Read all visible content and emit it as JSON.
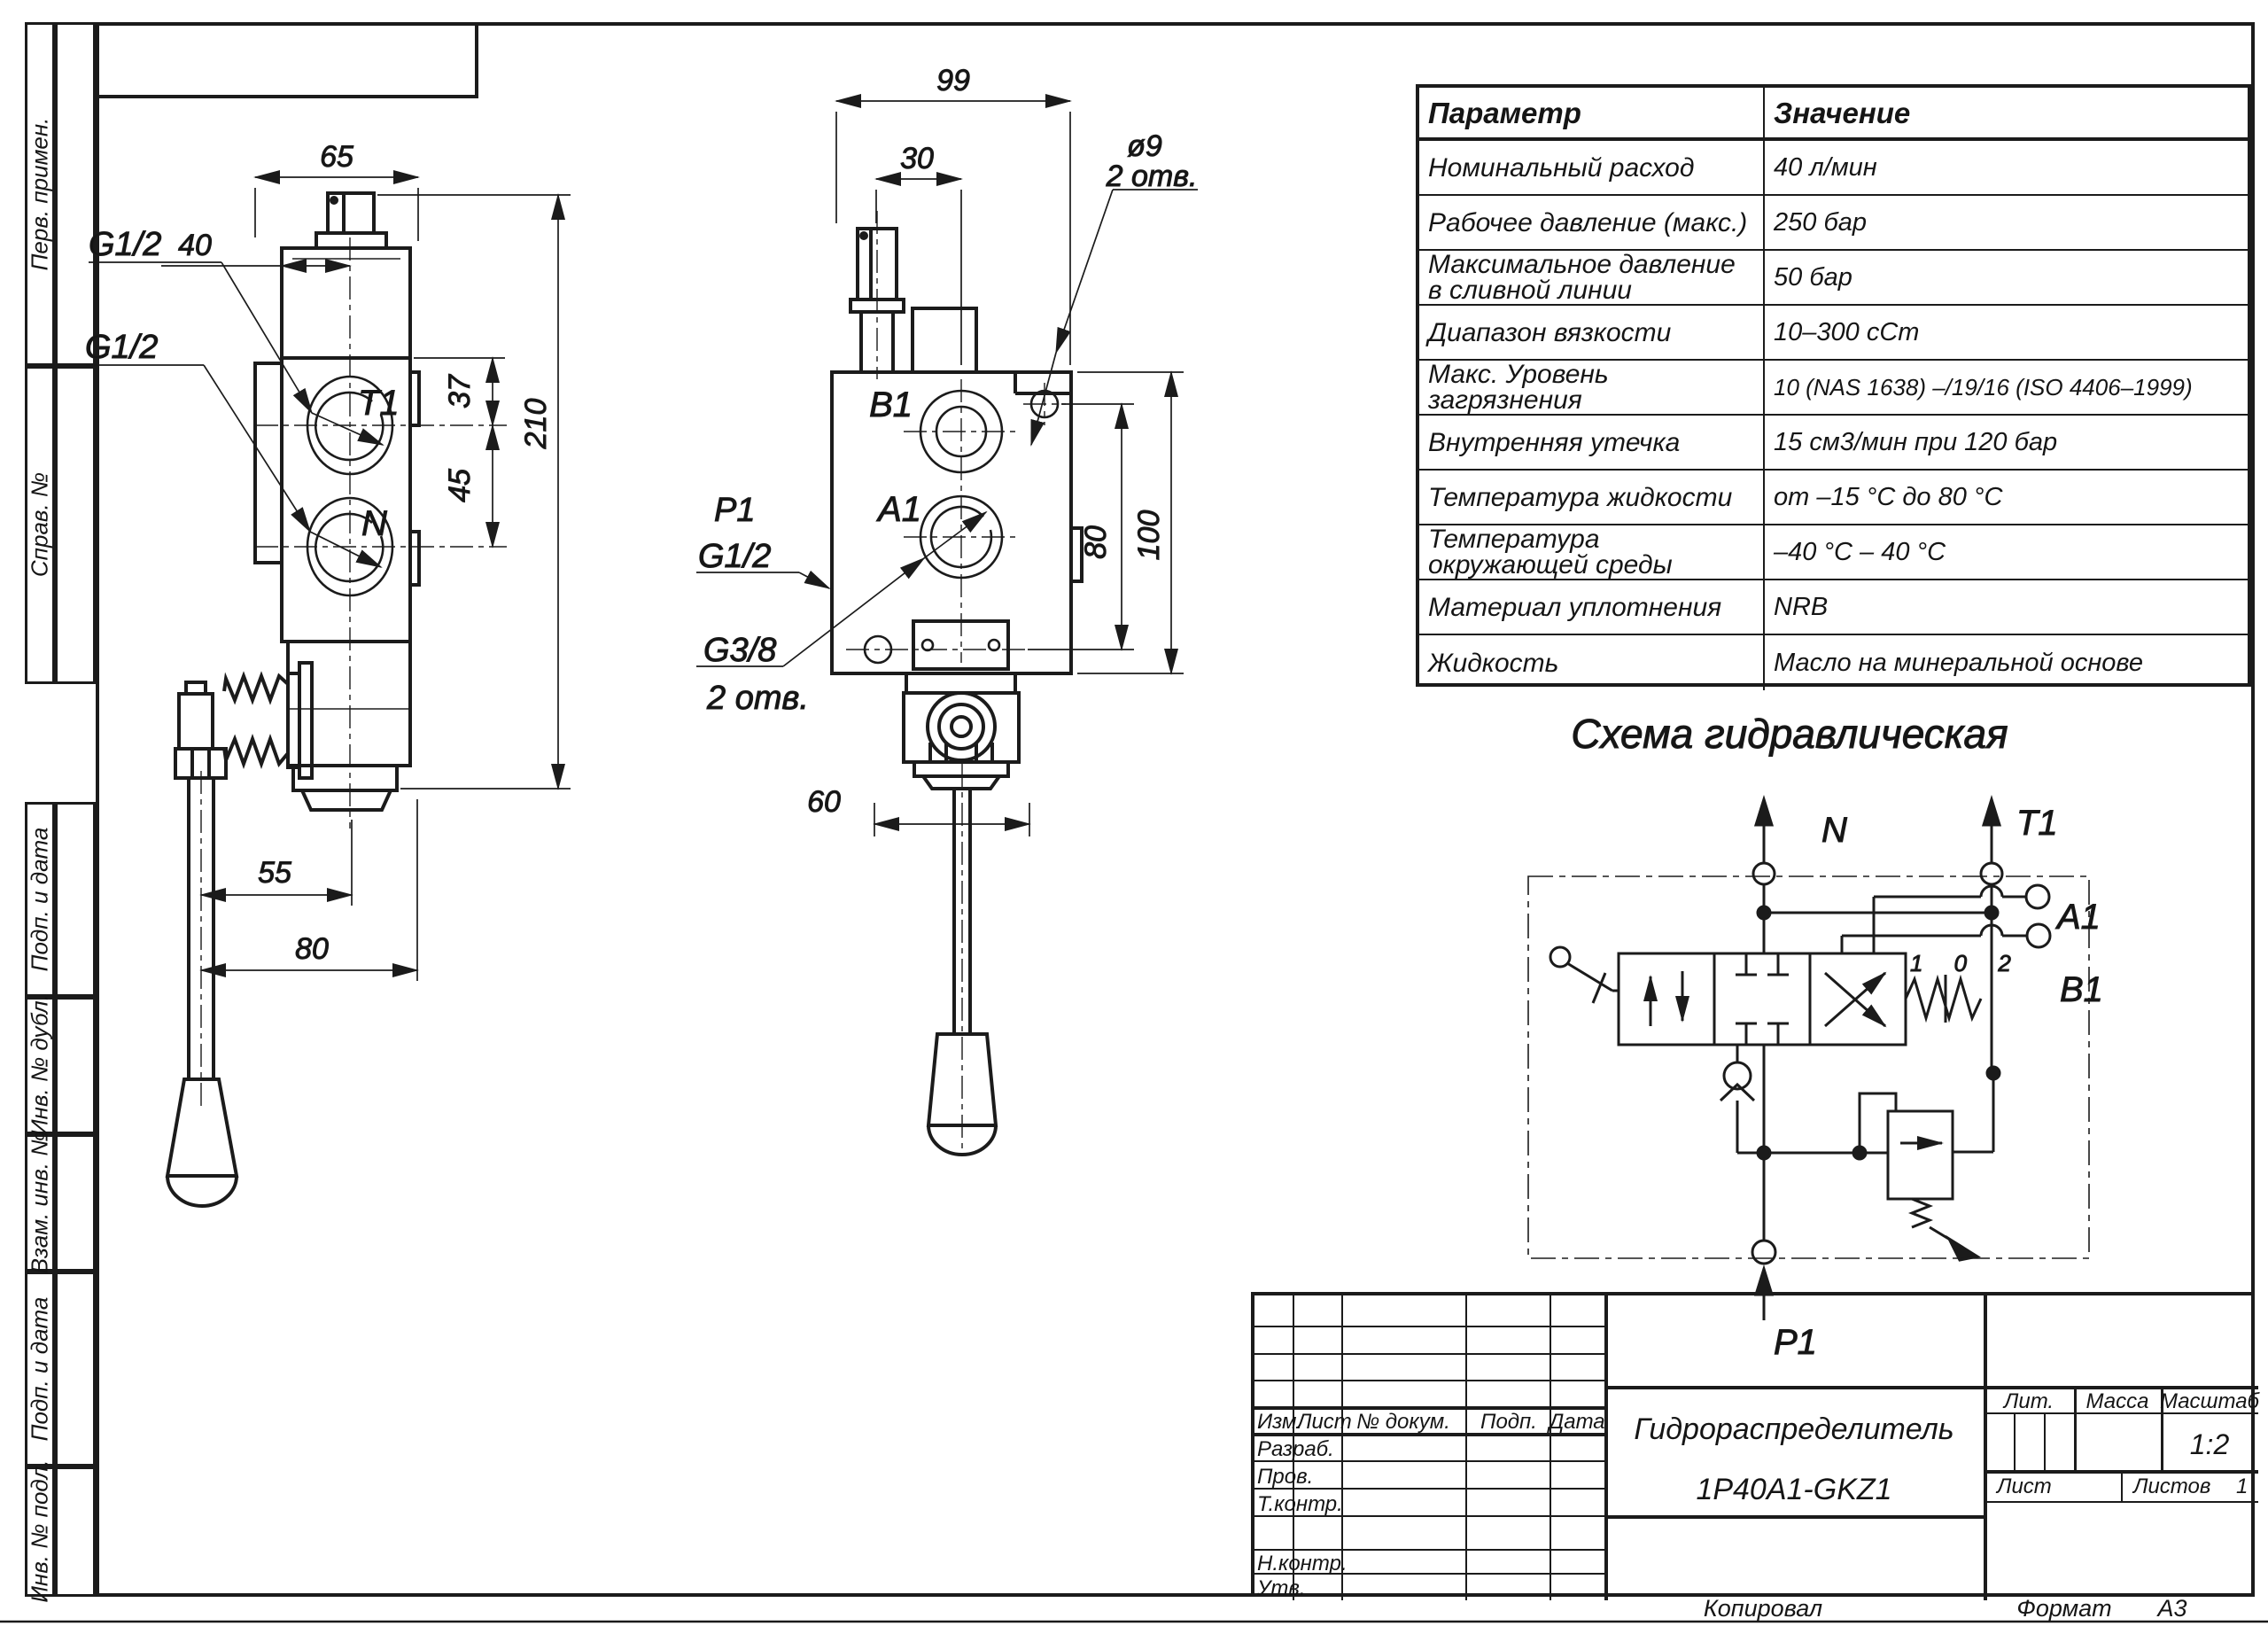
{
  "margin_labels": [
    "Перв. примен.",
    "Справ. №",
    "Подп. и дата",
    "Инв. № дубл.",
    "Взам. инв. №",
    "Подп. и дата",
    "Инв. № подл."
  ],
  "params_table": {
    "header": {
      "param": "Параметр",
      "value": "Значение"
    },
    "rows": [
      {
        "param": "Номинальный расход",
        "value": "40 л/мин"
      },
      {
        "param": "Рабочее давление (макс.)",
        "value": "250 бар"
      },
      {
        "param": "Максимальное давление в сливной линии",
        "value": "50 бар"
      },
      {
        "param": "Диапазон вязкости",
        "value": "10–300 сСт"
      },
      {
        "param": "Макс. Уровень загрязнения",
        "value": "10 (NAS 1638) –/19/16 (ISO 4406–1999)"
      },
      {
        "param": "Внутренняя утечка",
        "value": "15 см3/мин при 120 бар"
      },
      {
        "param": "Температура жидкости",
        "value": "от –15 °С до 80 °С"
      },
      {
        "param": "Температура окружающей среды",
        "value": "–40 °С – 40 °С"
      },
      {
        "param": "Материал уплотнения",
        "value": "NRB"
      },
      {
        "param": "Жидкость",
        "value": "Масло на минеральной основе"
      }
    ]
  },
  "left_view": {
    "dims": {
      "d65": "65",
      "d40": "40",
      "d37": "37",
      "d45": "45",
      "d210": "210",
      "d55": "55",
      "d80": "80"
    },
    "labels": {
      "g12_top": "G1/2",
      "g12_bot": "G1/2",
      "t1": "T1",
      "n": "N"
    }
  },
  "middle_view": {
    "dims": {
      "d99": "99",
      "d30": "30",
      "d80": "80",
      "d100": "100",
      "d60": "60"
    },
    "labels": {
      "dia9": "ø9",
      "dia9_holes": "2 отв.",
      "b1": "B1",
      "a1": "A1",
      "p1": "P1",
      "g12": "G1/2",
      "g38": "G3/8",
      "g38_holes": "2 отв."
    }
  },
  "schematic": {
    "title": "Схема гидравлическая",
    "positions": "1 0 2",
    "ports": {
      "n": "N",
      "t1": "T1",
      "a1": "A1",
      "b1": "B1",
      "p1": "P1"
    }
  },
  "title_block": {
    "izm": "Изм.",
    "list": "Лист",
    "n_dokum": "№ докум.",
    "podp": "Подп.",
    "data": "Дата",
    "razrab": "Разраб.",
    "prov": "Пров.",
    "t_kontr": "Т.контр.",
    "n_kontr": "Н.контр.",
    "utv": "Утв.",
    "doc_title_line1": "Гидрораспределитель",
    "doc_title_line2": "1P40A1-GKZ1",
    "lit": "Лит.",
    "massa": "Масса",
    "masshtab": "Масштаб",
    "scale_value": "1:2",
    "sheet_label": "Лист",
    "sheets_label": "Листов",
    "sheets_value": "1"
  },
  "footer": {
    "kopiroval": "Копировал",
    "format_label": "Формат",
    "format_value": "А3"
  }
}
